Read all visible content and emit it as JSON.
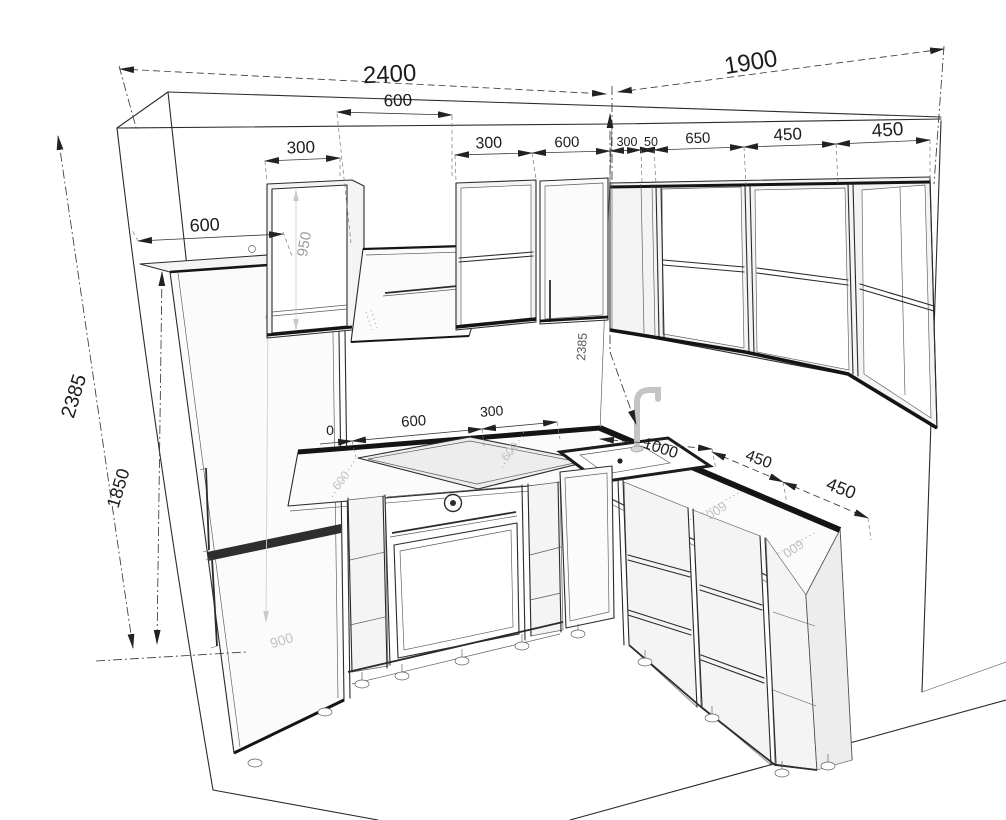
{
  "drawing": {
    "kind": "kitchen-3d-dimension-drawing",
    "colors": {
      "line": "#2b2b2b",
      "dimension": "#3a3a3a",
      "ghost_label": "#c2c2c2",
      "dark_band": "#141414",
      "faucet": "#c4c4c4",
      "background": "#ffffff"
    }
  },
  "dims": {
    "left_wall_total": "2400",
    "right_wall_total": "1900",
    "hood_width": "600",
    "left_wall_cab_1": "300",
    "left_wall_cab_2": "300",
    "left_wall_cab_3": "600",
    "right_filler_1": "300",
    "right_filler_2": "50",
    "right_wall_cab_1": "650",
    "right_wall_cab_2": "450",
    "right_wall_cab_3": "450",
    "fridge_depth": "600",
    "room_height": "2385",
    "fridge_height": "1850",
    "wall_cab_height": "950",
    "corner_wall_height": "2385",
    "counter_partial": "0",
    "counter_seg_1": "600",
    "counter_seg_2": "300",
    "sink_run_width": "1000",
    "base_cab_right_1": "450",
    "base_cab_right_2": "450",
    "counter_depth_1": "600",
    "counter_depth_2": "600",
    "counter_depth_3": "600",
    "counter_depth_4": "600",
    "fridge_width_ghost": "900"
  }
}
